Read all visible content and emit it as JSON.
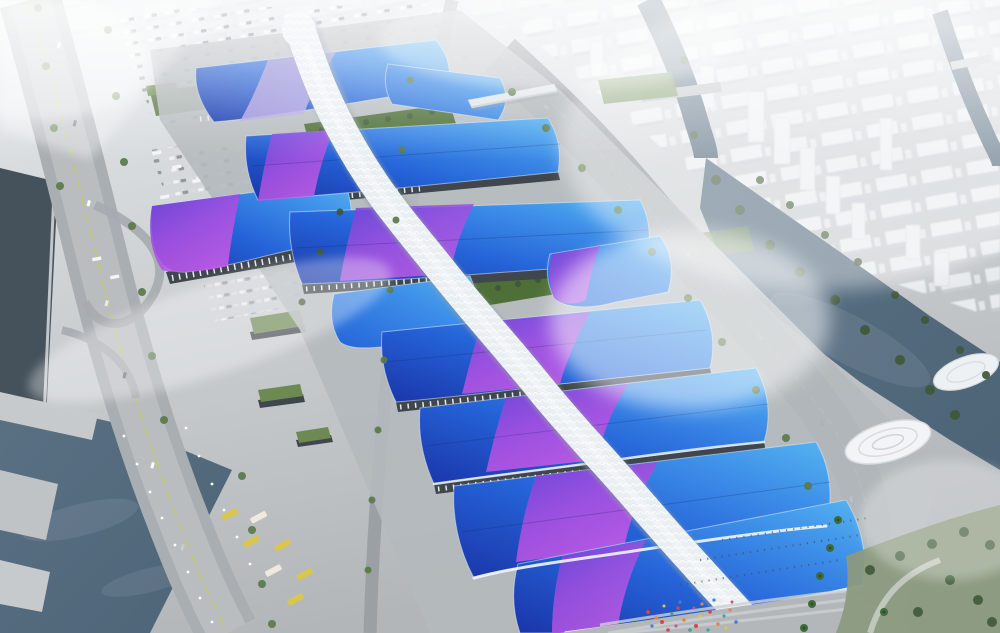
{
  "scene": {
    "type": "architectural-rendering",
    "view": "aerial",
    "subject": "riverside exhibition and convention center complex",
    "description": "Aerial architectural rendering of a large exhibition center: rows of wavy blue hall roofs crossed by sweeping violet-to-magenta ribbon bands, a white diamond-lattice serpentine skybridge spine running diagonally through the halls, green courtyard gardens, grey plazas with an entrance crowd, tree-lined highways, canals and rivers, parking lots full of cars, and a hazy white city skyline.",
    "landmarks": [
      "exhibition-hall-roofs",
      "skybridge-spine",
      "courtyard-gardens",
      "entrance-plaza",
      "west-highway",
      "east-boulevard",
      "west-canal",
      "east-river",
      "city-district",
      "parking-lots",
      "bus-depot",
      "sculptural-pavilions"
    ]
  },
  "palette": {
    "base-light": "#e6eaec",
    "base-mid": "#cdd1d4",
    "base-dark": "#b2b6b9",
    "plaza": "#b4b9bc",
    "road": "#8f959a",
    "road-light": "#b3b7ba",
    "lane-green": "#c3cf49",
    "water-dark": "#45525c",
    "water-blue": "#4d6477",
    "tree-dark": "#3f5837",
    "tree": "#5b7a4a",
    "grass": "#4e7038",
    "lawn": "#6d8a52",
    "roof-navy": "#1a35a8",
    "roof-blue": "#2563d8",
    "roof-azure": "#3d8ee8",
    "roof-cyan": "#55b4f0",
    "violet": "#6f41d6",
    "purple": "#a44fe0",
    "magenta": "#c35ae6",
    "lavender": "#9b8ad0",
    "spine": "#e9eff3",
    "spine-shade": "#8e9ca8",
    "facade": "#3f464d",
    "column": "#e8ebee",
    "city-block": "#eff2f4",
    "city-shadow": "#c9ced2",
    "bus-yellow": "#d9c64d",
    "fog": "#ffffff"
  },
  "crowd_colors": [
    "#d84545",
    "#e8883c",
    "#38a89e",
    "#4a79d6",
    "#e2c83e",
    "#c94f8e"
  ]
}
